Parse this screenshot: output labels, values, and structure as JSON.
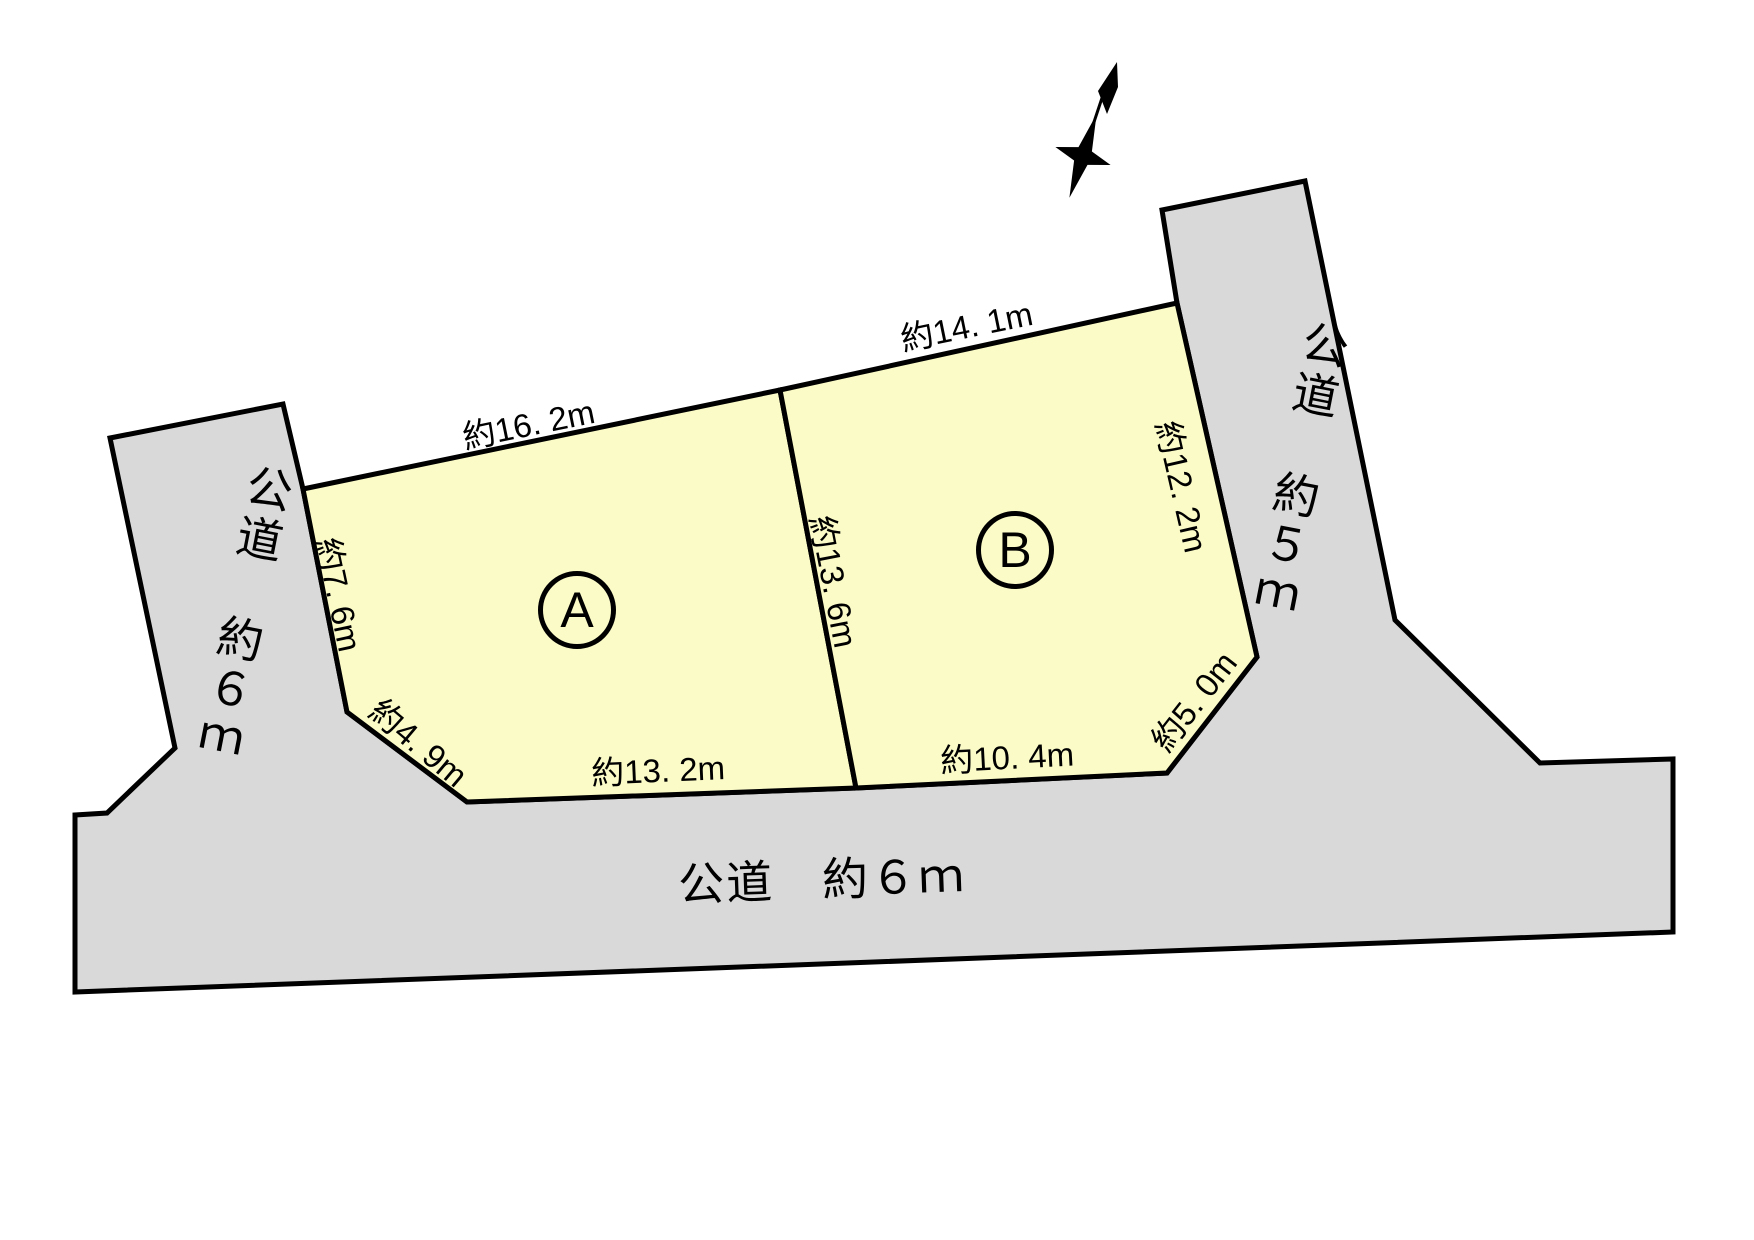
{
  "title": "土地区画図",
  "colors": {
    "road_fill": "#d9d9d9",
    "parcel_fill": "#fbfbc8",
    "outline": "#000000",
    "background": "#ffffff"
  },
  "north_arrow": {
    "meaning": "north-direction-arrow"
  },
  "roads": {
    "left": {
      "label": "公道　約６ｍ"
    },
    "right": {
      "label": "公道　約５ｍ"
    },
    "bottom": {
      "label": "公道　約６ｍ"
    }
  },
  "parcels": {
    "a": {
      "badge": "A",
      "dimensions": {
        "top": "約16. 2m",
        "left": "約7. 6m",
        "bottom_left_diagonal": "約4. 9m",
        "bottom": "約13. 2m"
      }
    },
    "b": {
      "badge": "B",
      "dimensions": {
        "top": "約14. 1m",
        "right": "約12. 2m",
        "bottom_right_diagonal": "約5. 0m",
        "bottom": "約10. 4m"
      }
    },
    "shared_divider": {
      "dimension": "約13. 6m"
    }
  }
}
